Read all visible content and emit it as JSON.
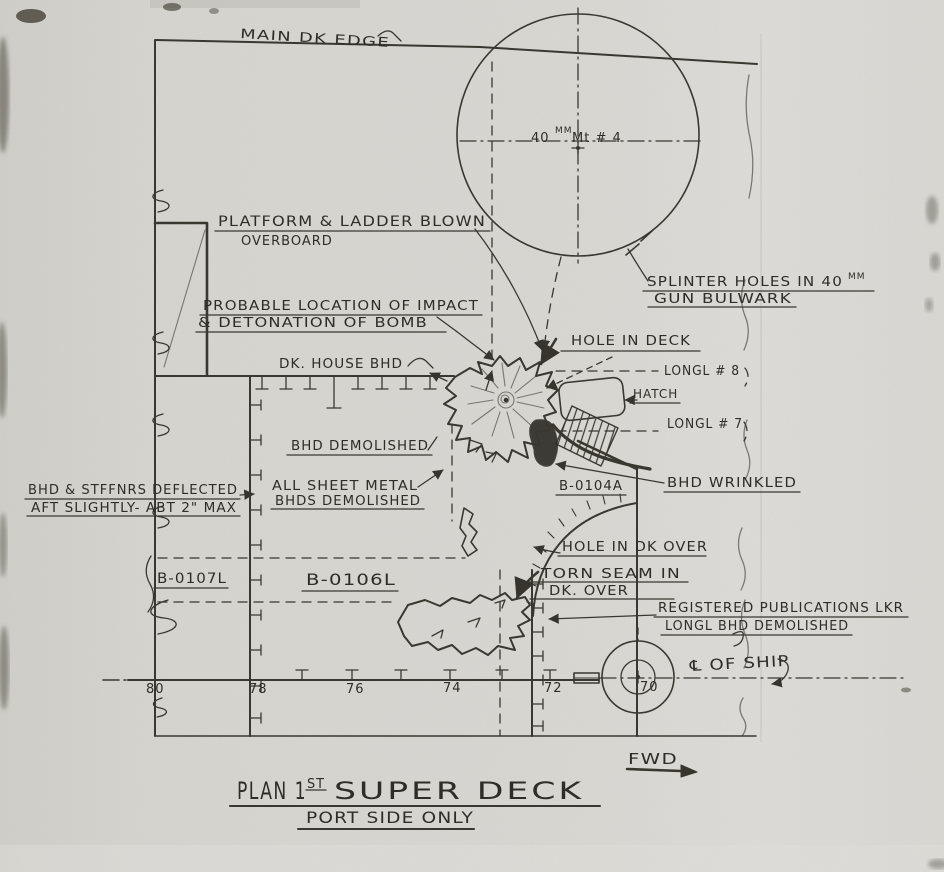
{
  "colors": {
    "paper": "#d8d6d1",
    "ink": "#35332c"
  },
  "title": {
    "line1_pre": "PLAN 1",
    "line1_sup": "ST",
    "line1_post": "SUPER DECK",
    "line2": "PORT SIDE ONLY"
  },
  "frames": [
    "80",
    "78",
    "76",
    "74",
    "72",
    "70"
  ],
  "annotations": {
    "main_dk_edge": "MAIN DK EDGE",
    "gun_num": "40",
    "gun_sup": "MM",
    "gun_rest": "Mt # 4",
    "platform_1": "PLATFORM & LADDER BLOWN",
    "platform_2": "OVERBOARD",
    "splinter_1": "SPLINTER HOLES IN 40",
    "splinter_sup": "MM",
    "splinter_2": "GUN BULWARK",
    "probable_1": "PROBABLE LOCATION OF IMPACT",
    "probable_2": "& DETONATION OF BOMB",
    "dk_house_bhd": "DK. HOUSE BHD",
    "hole_in_deck": "HOLE IN DECK",
    "longl_8": "LONGL # 8",
    "hatch": "HATCH",
    "longl_7": "LONGL # 7",
    "bhd_demolished": "BHD DEMOLISHED",
    "sheet_metal_1": "ALL SHEET METAL",
    "sheet_metal_2": "BHDS DEMOLISHED",
    "deflected_1": "BHD & STFFNRS DEFLECTED",
    "deflected_2": "AFT SLIGHTLY- ABT 2\" MAX",
    "b0104a": "B-0104A",
    "bhd_wrinkled": "BHD WRINKLED",
    "hole_in_dk_over": "HOLE IN DK OVER",
    "b0107l": "B-0107L",
    "b0106l": "B-0106L",
    "torn_seam_1": "TORN SEAM IN",
    "torn_seam_2": "DK. OVER",
    "reg_pubs_1": "REGISTERED PUBLICATIONS LKR",
    "reg_pubs_2": "LONGL BHD DEMOLISHED",
    "centerline": "℄ OF SHIP",
    "fwd": "FWD"
  }
}
